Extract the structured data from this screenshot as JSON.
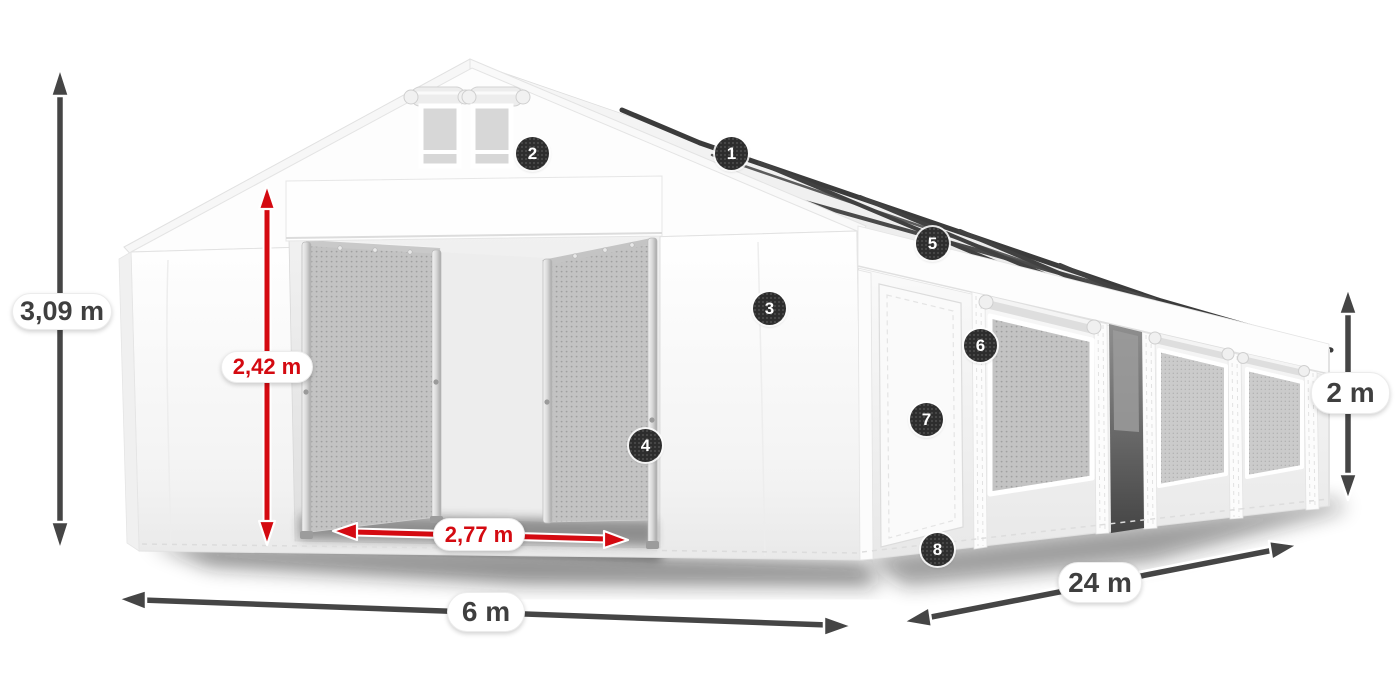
{
  "illustration": {
    "description": "White PVC tent shown in 3D perspective with eight numbered feature callouts and dimension arrows"
  },
  "colors": {
    "accent_red": "#d40a11",
    "arrow_dark": "#454545",
    "badge_bg": "#2d2d2d",
    "badge_text": "#ffffff",
    "label_bg": "#ffffff",
    "label_text": "#3f3f3f"
  },
  "dimensions": {
    "total_height": {
      "label": "3,09 m"
    },
    "door_height": {
      "label": "2,42 m"
    },
    "door_width": {
      "label": "2,77 m"
    },
    "width": {
      "label": "6 m"
    },
    "length": {
      "label": "24 m"
    },
    "side_height": {
      "label": "2 m"
    }
  },
  "badges": [
    {
      "number": "1"
    },
    {
      "number": "2"
    },
    {
      "number": "3"
    },
    {
      "number": "4"
    },
    {
      "number": "5"
    },
    {
      "number": "6"
    },
    {
      "number": "7"
    },
    {
      "number": "8"
    }
  ]
}
